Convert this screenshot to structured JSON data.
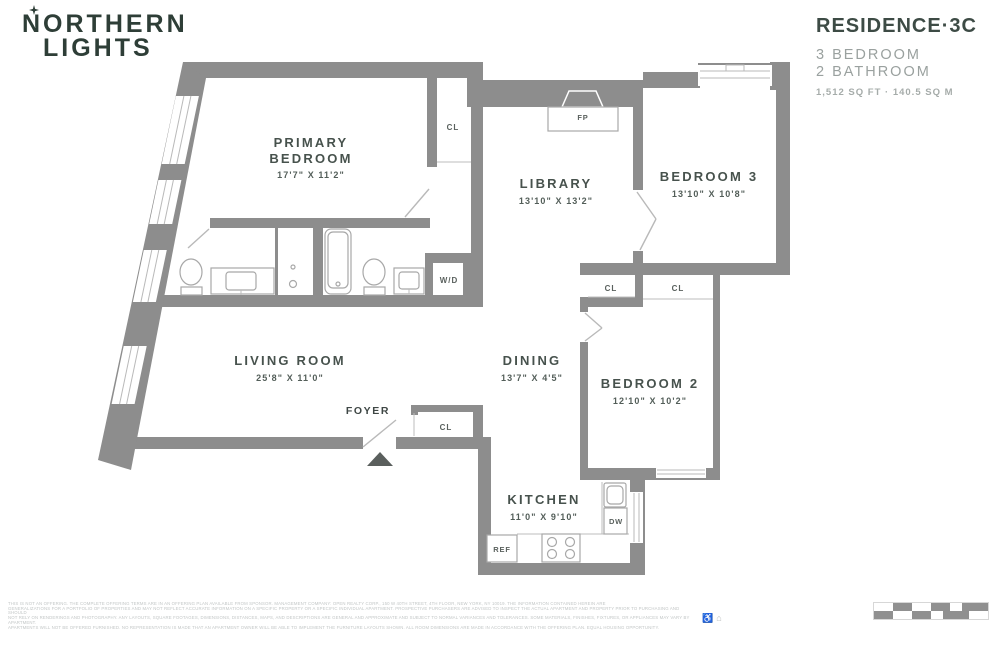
{
  "header": {
    "logo_line1": "NORTHERN",
    "logo_line2": "LIGHTS",
    "residence_title": "RESIDENCE·3C",
    "spec_line1": "3 BEDROOM",
    "spec_line2": "2 BATHROOM",
    "area": "1,512 SQ FT · 140.5 SQ M"
  },
  "floorplan": {
    "rooms": {
      "primary_bedroom": {
        "label1": "PRIMARY",
        "label2": "BEDROOM",
        "dims": "17'7\" X 11'2\""
      },
      "library": {
        "label": "LIBRARY",
        "dims": "13'10\" X 13'2\""
      },
      "bedroom3": {
        "label": "BEDROOM 3",
        "dims": "13'10\" X 10'8\""
      },
      "living_room": {
        "label": "LIVING ROOM",
        "dims": "25'8\" X 11'0\""
      },
      "dining": {
        "label": "DINING",
        "dims": "13'7\" X 4'5\""
      },
      "bedroom2": {
        "label": "BEDROOM 2",
        "dims": "12'10\" X 10'2\""
      },
      "kitchen": {
        "label": "KITCHEN",
        "dims": "11'0\" X 9'10\""
      },
      "foyer": {
        "label": "FOYER"
      }
    },
    "fixtures": {
      "fireplace": "FP",
      "closet": "CL",
      "washer_dryer": "W/D",
      "dishwasher": "DW",
      "refrigerator": "REF"
    }
  },
  "footer": {
    "disclaimer_line1": "THIS IS NOT AN OFFERING. THE COMPLETE OFFERING TERMS ARE IN AN OFFERING PLAN AVAILABLE FROM SPONSOR. MANAGEMENT COMPANY: OPEN REALTY CORP., 150 W 40TH STREET, 4TH FLOOR, NEW YORK, NY 10019. THE INFORMATION CONTAINED HEREIN ARE",
    "disclaimer_line2": "GENERALIZATIONS FOR A PORTFOLIO OF PROPERTIES AND MAY NOT REFLECT ACCURATE INFORMATION ON A SPECIFIC PROPERTY OR A SPECIFIC INDIVIDUAL APARTMENT. PROSPECTIVE PURCHASERS ARE ADVISED TO INSPECT THE ACTUAL APARTMENT AND PROPERTY PRIOR TO PURCHASING AND SHOULD",
    "disclaimer_line3": "NOT RELY ON RENDERINGS AND PHOTOGRAPHY. ANY LAYOUTS, SQUARE FOOTAGES, DIMENSIONS, DISTANCES, MAPS, AND DESCRIPTIONS ARE GENERAL AND APPROXIMATE AND SUBJECT TO NORMAL VARIANCES AND TOLERANCES. SOME MATERIALS, FINISHES, FIXTURES, OR APPLIANCES MAY VARY BY APARTMENT.",
    "disclaimer_line4": "APARTMENTS WILL NOT BE OFFERED FURNISHED. NO REPRESENTATION IS MADE THAT AN APARTMENT OWNER WILL BE ABLE TO IMPLEMENT THE FURNITURE LAYOUTS SHOWN. ALL ROOM DIMENSIONS ARE MADE IN ACCORDANCE WITH THE OFFERING PLAN. EQUAL HOUSING OPPORTUNITY.",
    "accessibility_icon": "♿",
    "equal_housing_icon": "⌂"
  },
  "colors": {
    "wall": "#8d8d8d",
    "accent_green": "#3d4b45",
    "logo_green": "#2e3e37",
    "room_label": "#47524d",
    "muted_gray": "#9aa19f",
    "fixture_stroke": "#a8a8a8"
  }
}
